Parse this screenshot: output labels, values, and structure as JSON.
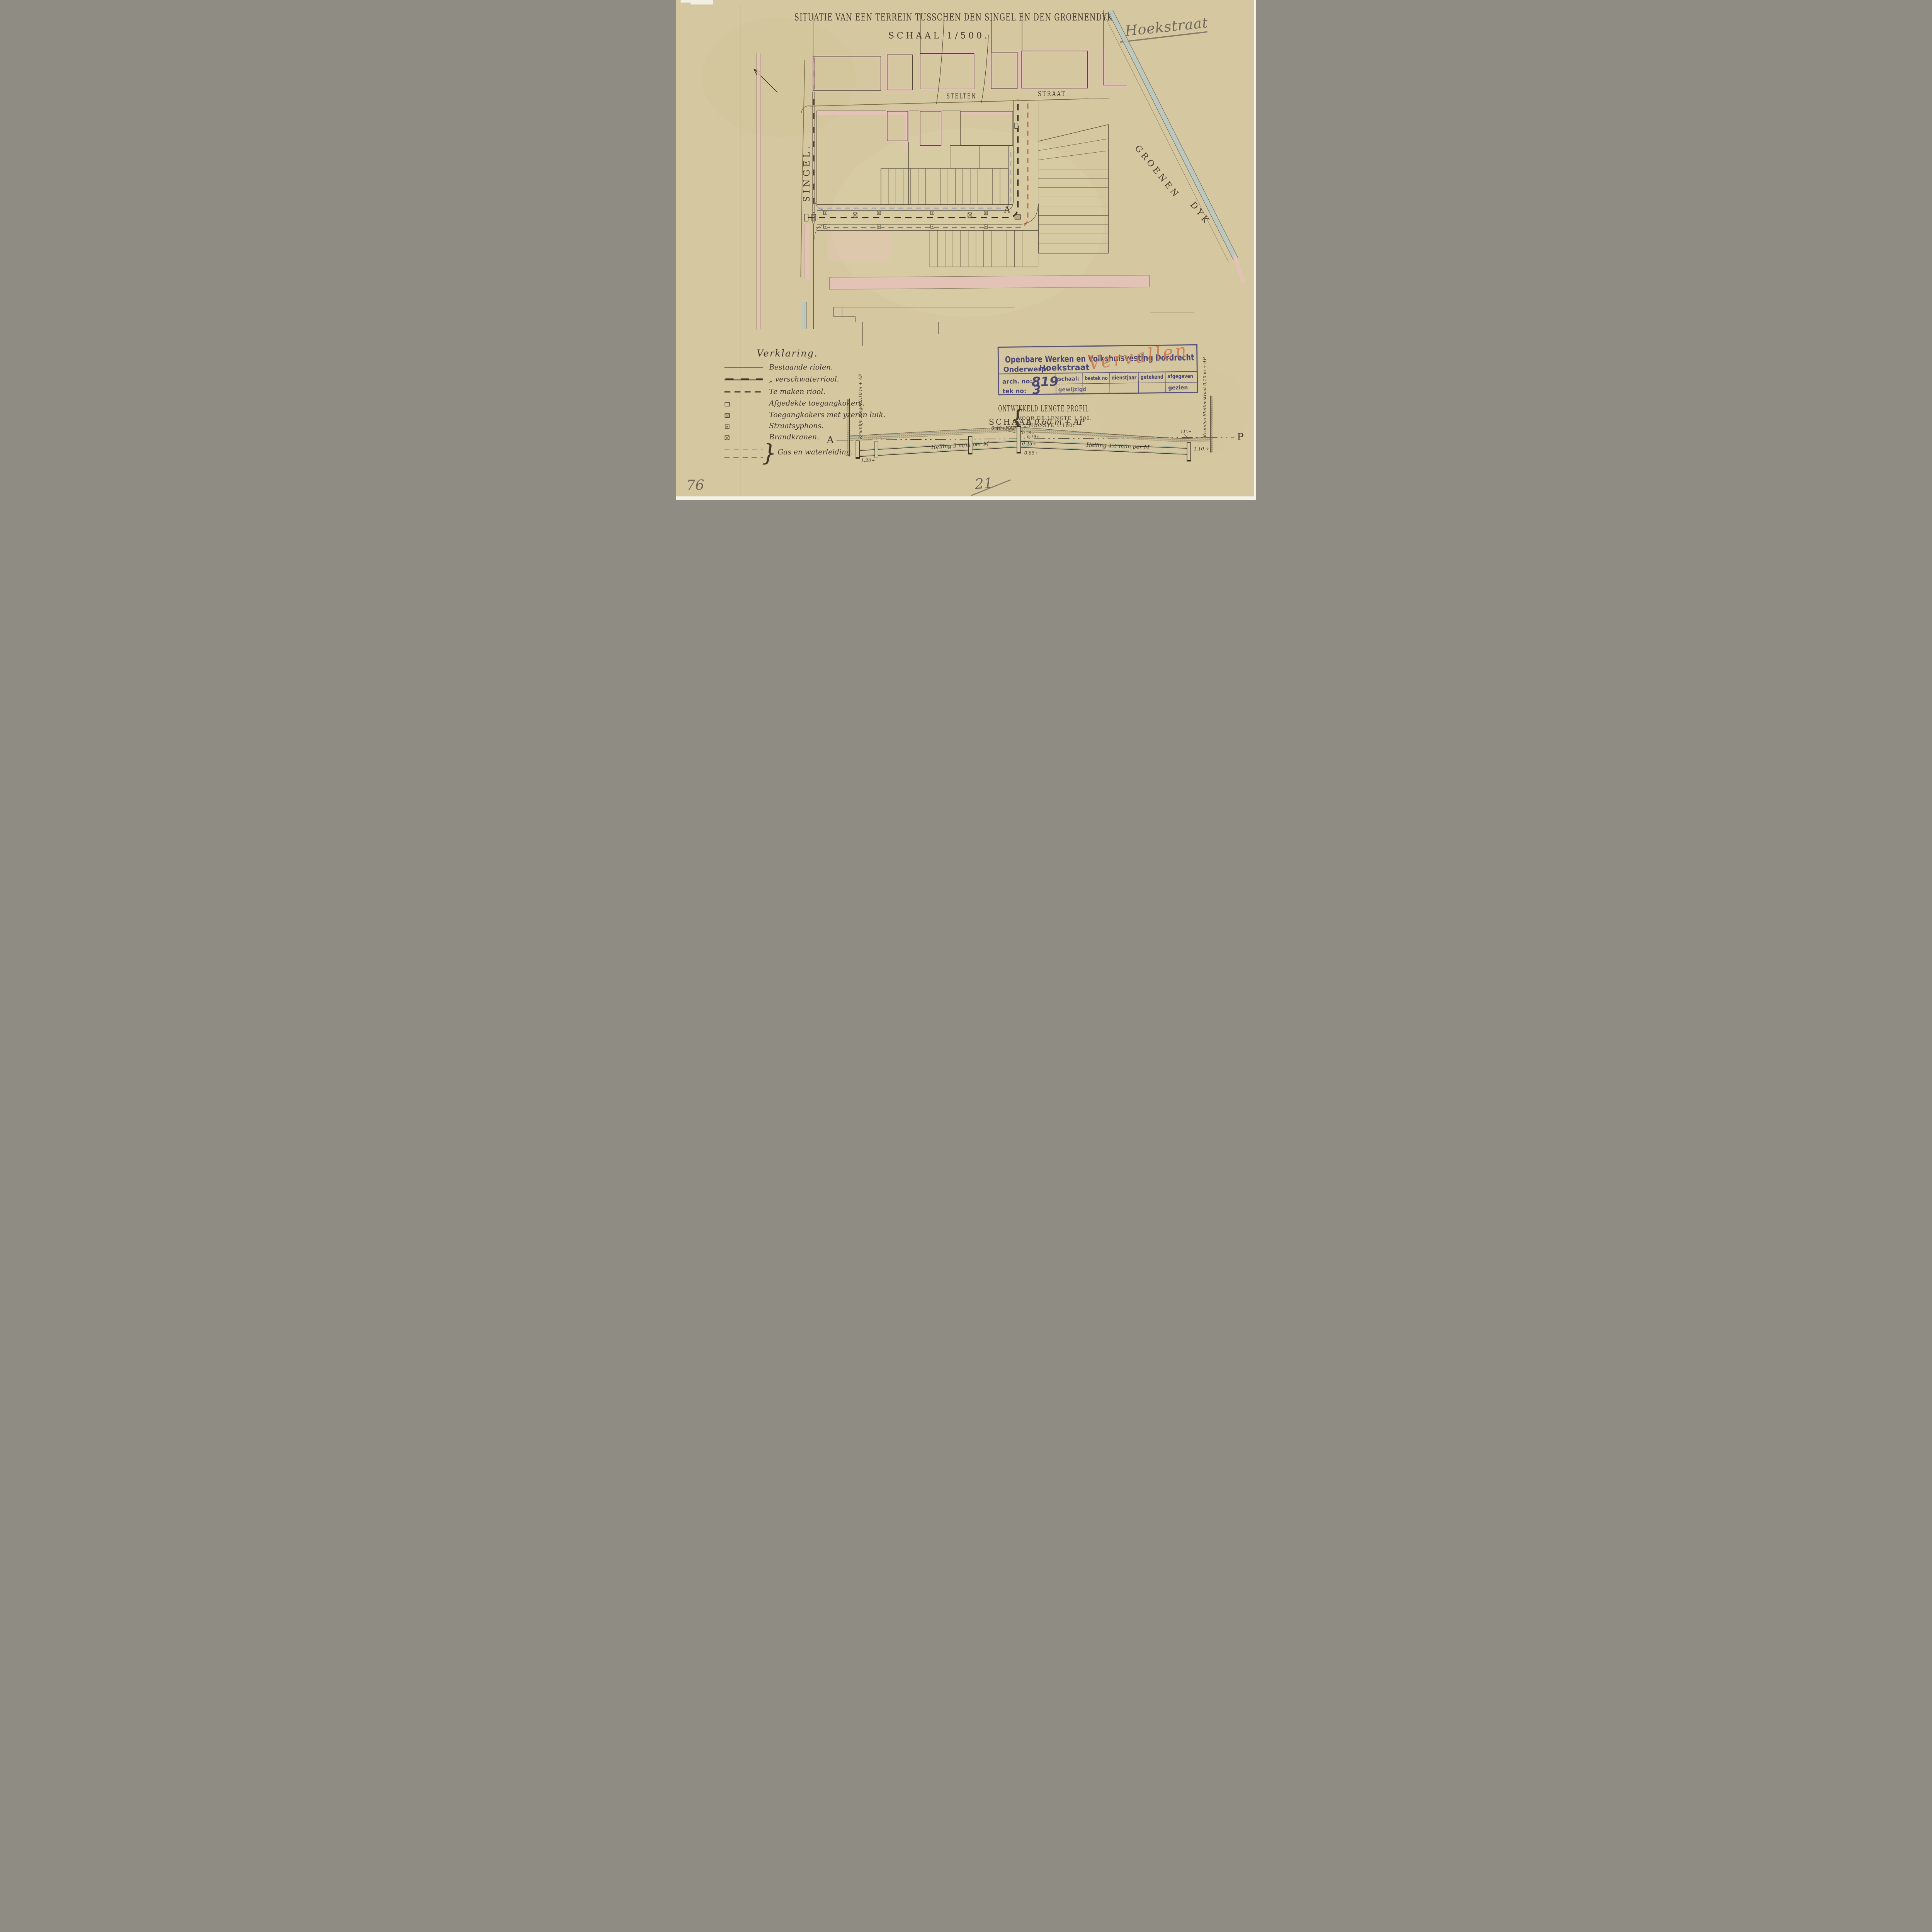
{
  "document": {
    "type": "archival technical drawing (scan)",
    "language": "Dutch"
  },
  "colors": {
    "paper": "#d6c9a2",
    "ink": "#3c342b",
    "sepia_line": "#7d6b46",
    "pink_wash": "#e7c2bb",
    "blue_wash": "#b7c8c2",
    "red_dash": "#bf5140",
    "water_dash": "#9aa6b6",
    "stamp_purple": "#4a4675",
    "crayon_orange": "#cf7a50",
    "pencil": "#6e675c"
  },
  "title": {
    "main": "SITUATIE VAN EEN TERREIN TUSSCHEN DEN SINGEL EN DEN GROENENDYK",
    "schaal": "SCHAAL 1/500."
  },
  "pencil": {
    "top_right": "Hoekstraat",
    "bottom_left": "76",
    "bottom_center": "21"
  },
  "map": {
    "labels": {
      "stelten": "STELTEN",
      "straat": "STRAAT",
      "singel": "SINGEL.",
      "groenen": "GROENEN",
      "dyk": "DYK"
    },
    "point_a": "A"
  },
  "legend": {
    "title": "Verklaring.",
    "brace": "}",
    "items": [
      {
        "symbol": "existing-sewer-line",
        "label": "Bestaande riolen."
      },
      {
        "symbol": "existing-freshwater-sewer-line",
        "label": "„      verschwaterriool."
      },
      {
        "symbol": "planned-sewer-dashed-line",
        "label": "Te maken riool."
      },
      {
        "symbol": "covered-access-shaft-square",
        "label": "Afgedekte toegangkokers."
      },
      {
        "symbol": "access-shaft-iron-lid-square",
        "label": "Toegangkokers met yzeren luik."
      },
      {
        "symbol": "street-syphon-square",
        "label": "Straatsyphons."
      },
      {
        "symbol": "fire-hydrant-square",
        "label": "Brandkranen."
      },
      {
        "symbol": "gas-and-water-dashed-lines",
        "label": "Gas en waterleiding."
      }
    ]
  },
  "stamp": {
    "header": "Openbare Werken en Volkshuisvesting Dordrecht",
    "onderwerp_label": "Onderwerp:",
    "onderwerp_value": "Hoekstraat",
    "vervallen": "Vervallen",
    "arch_label": "arch. no:",
    "arch_value": "819",
    "tek_label": "tek no:",
    "tek_value": "3",
    "columns": {
      "schaal": "schaal:",
      "bestek": "bestek no",
      "dienstjaar": "dienstjaar",
      "getekend": "getekend",
      "afgegeven": "afgegeven"
    },
    "gewijzigd": "gewijzigd",
    "gezien": "gezien"
  },
  "profile": {
    "title": "ONTWIKKELD LENGTE PROFIL",
    "schaal_label": "SCHAAL",
    "brace": "{",
    "schaal_line1": "VOOR DE LENGTE 1:500.",
    "schaal_line2": "„  „  HOOGTE 1:100.",
    "end_left": "A",
    "end_right": "P",
    "crest_left": "Kruinlijn Singel 0,10 m + AP",
    "crest_right": "Kruinlyn Steltenstraat 0,10 m + AP",
    "nap": "0.40+NAP",
    "top_a": "A 0.60 m + AP",
    "v_025": "0.25+",
    "v_019": "0.19+",
    "v_045": "0.45÷",
    "v_085": "0.85÷",
    "v_110": "1.10.÷",
    "v_120": "1.20÷",
    "note_right": "11'.÷",
    "helling_left": "Helling 3 m/m per M",
    "helling_right": "Helling 4½ m/m per M"
  }
}
